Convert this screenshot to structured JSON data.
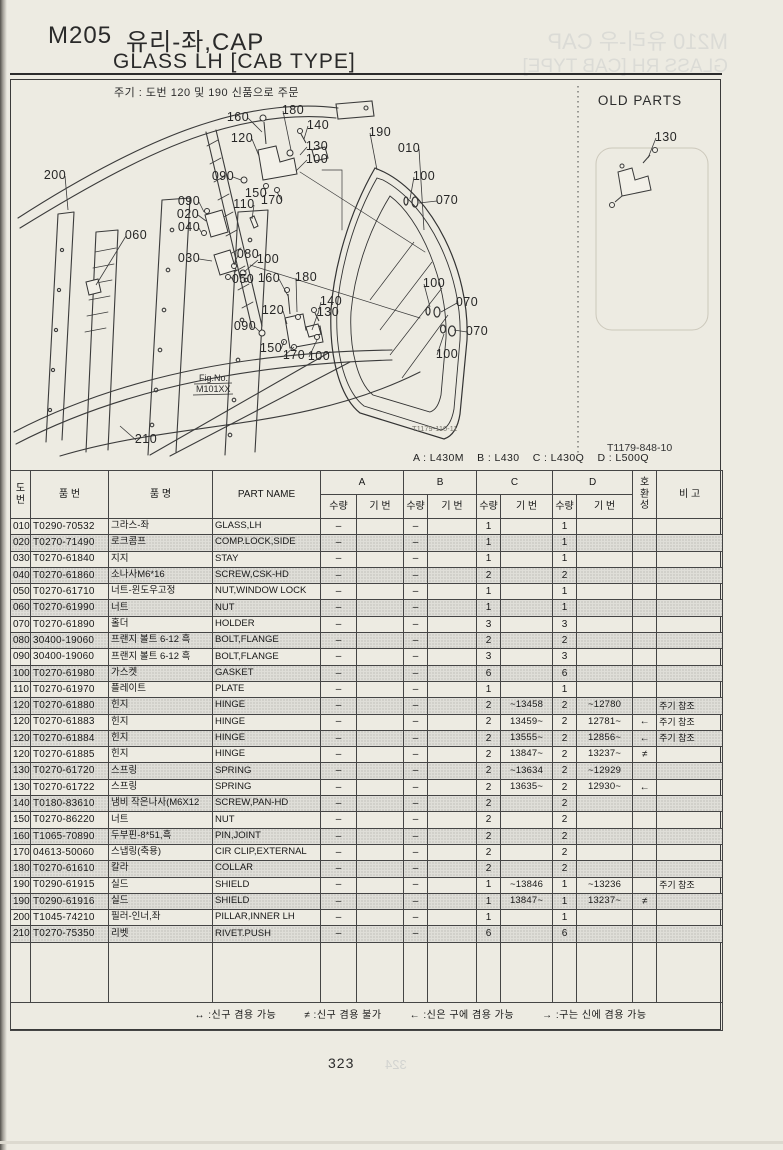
{
  "page": {
    "title_code": "M205",
    "title_kr": "유리-좌,CAP",
    "title_en": "GLASS LH [CAB TYPE]",
    "note": "주기 : 도번 120 및 190 신품으로 주문",
    "page_number": "323"
  },
  "ghost": {
    "line1": "M210 유리-우 CAP",
    "line2": "GLASS RH [CAB TYPE]",
    "next_page": "324"
  },
  "diagram": {
    "old_parts_label": "OLD PARTS",
    "fig_no_label": "Fig.No.",
    "fig_no_value": "M101XX",
    "drawing_code_left": "T1179-110-11",
    "drawing_code_right": "T1179-848-10",
    "callouts": [
      {
        "t": "160",
        "x": 238,
        "y": 121,
        "ex": 262,
        "ey": 132
      },
      {
        "t": "180",
        "x": 293,
        "y": 114,
        "ex": 291,
        "ey": 150
      },
      {
        "t": "140",
        "x": 318,
        "y": 129,
        "ex": 304,
        "ey": 139
      },
      {
        "t": "120",
        "x": 242,
        "y": 142,
        "ex": 259,
        "ey": 156
      },
      {
        "t": "130",
        "x": 317,
        "y": 150,
        "ex": 300,
        "ey": 155
      },
      {
        "t": "100",
        "x": 317,
        "y": 163,
        "ex": 296,
        "ey": 171
      },
      {
        "t": "090",
        "x": 223,
        "y": 180,
        "ex": 241,
        "ey": 180
      },
      {
        "t": "150",
        "x": 256,
        "y": 197,
        "ex": 265,
        "ey": 188
      },
      {
        "t": "170",
        "x": 272,
        "y": 204,
        "ex": 277,
        "ey": 192
      },
      {
        "t": "110",
        "x": 244,
        "y": 208,
        "ex": 252,
        "ey": 219
      },
      {
        "t": "190",
        "x": 380,
        "y": 136,
        "ex": 377,
        "ey": 170
      },
      {
        "t": "010",
        "x": 409,
        "y": 152,
        "ex": 424,
        "ey": 230
      },
      {
        "t": "100",
        "x": 424,
        "y": 180,
        "ex": 410,
        "ey": 199
      },
      {
        "t": "070",
        "x": 447,
        "y": 204,
        "ex": 419,
        "ey": 203
      },
      {
        "t": "090",
        "x": 189,
        "y": 205,
        "ex": 204,
        "ey": 212
      },
      {
        "t": "020",
        "x": 188,
        "y": 218,
        "ex": 206,
        "ey": 221
      },
      {
        "t": "040",
        "x": 189,
        "y": 231,
        "ex": 201,
        "ey": 232
      },
      {
        "t": "030",
        "x": 189,
        "y": 262,
        "ex": 212,
        "ey": 261
      },
      {
        "t": "080",
        "x": 248,
        "y": 258,
        "ex": 234,
        "ey": 265
      },
      {
        "t": "100",
        "x": 268,
        "y": 263,
        "ex": 244,
        "ey": 272
      },
      {
        "t": "050",
        "x": 243,
        "y": 283,
        "ex": 231,
        "ey": 277
      },
      {
        "t": "160",
        "x": 269,
        "y": 282,
        "ex": 288,
        "ey": 296
      },
      {
        "t": "180",
        "x": 306,
        "y": 281,
        "ex": 297,
        "ey": 312
      },
      {
        "t": "140",
        "x": 331,
        "y": 305,
        "ex": 318,
        "ey": 314
      },
      {
        "t": "120",
        "x": 273,
        "y": 314,
        "ex": 287,
        "ey": 324
      },
      {
        "t": "130",
        "x": 328,
        "y": 316,
        "ex": 312,
        "ey": 330
      },
      {
        "t": "090",
        "x": 245,
        "y": 330,
        "ex": 260,
        "ey": 332
      },
      {
        "t": "150",
        "x": 271,
        "y": 352,
        "ex": 284,
        "ey": 341
      },
      {
        "t": "170",
        "x": 294,
        "y": 359,
        "ex": 294,
        "ey": 347
      },
      {
        "t": "100",
        "x": 319,
        "y": 360,
        "ex": 317,
        "ey": 340
      },
      {
        "t": "100",
        "x": 434,
        "y": 287,
        "ex": 430,
        "ey": 307
      },
      {
        "t": "070",
        "x": 467,
        "y": 306,
        "ex": 441,
        "ey": 312
      },
      {
        "t": "070",
        "x": 477,
        "y": 335,
        "ex": 454,
        "ey": 330
      },
      {
        "t": "100",
        "x": 447,
        "y": 358,
        "ex": 444,
        "ey": 334
      },
      {
        "t": "200",
        "x": 55,
        "y": 179,
        "ex": 68,
        "ey": 210
      },
      {
        "t": "060",
        "x": 136,
        "y": 239,
        "ex": 96,
        "ey": 285
      },
      {
        "t": "210",
        "x": 146,
        "y": 443,
        "ex": 120,
        "ey": 426
      },
      {
        "t": "130",
        "x": 666,
        "y": 141,
        "ex": 648,
        "ey": 158
      }
    ]
  },
  "table": {
    "models_line": "A : L430M    B : L430    C : L430Q    D : L500Q",
    "headers": {
      "no_stacked": "도|번",
      "part_no": "품  번",
      "name_kr": "품  명",
      "part_name": "PART NAME",
      "groups": [
        "A",
        "B",
        "C",
        "D"
      ],
      "qty": "수량",
      "serial": "기 번",
      "compat_stacked": "호|환|성",
      "remark": "비  고"
    },
    "rows": [
      {
        "no": "010",
        "pn": "T0290-70532",
        "kr": "그라스-좌",
        "en": "GLASS,LH",
        "aq": "–",
        "as": "",
        "bq": "–",
        "bs": "",
        "cq": "1",
        "cs": "",
        "dq": "1",
        "ds": "",
        "cp": "",
        "rm": "",
        "shaded": false
      },
      {
        "no": "020",
        "pn": "T0270-71490",
        "kr": "로크콤프",
        "en": "COMP.LOCK,SIDE",
        "aq": "–",
        "as": "",
        "bq": "–",
        "bs": "",
        "cq": "1",
        "cs": "",
        "dq": "1",
        "ds": "",
        "cp": "",
        "rm": "",
        "shaded": true
      },
      {
        "no": "030",
        "pn": "T0270-61840",
        "kr": "지지",
        "en": "STAY",
        "aq": "–",
        "as": "",
        "bq": "–",
        "bs": "",
        "cq": "1",
        "cs": "",
        "dq": "1",
        "ds": "",
        "cp": "",
        "rm": "",
        "shaded": false
      },
      {
        "no": "040",
        "pn": "T0270-61860",
        "kr": "소나사M6*16",
        "en": "SCREW,CSK-HD",
        "aq": "–",
        "as": "",
        "bq": "–",
        "bs": "",
        "cq": "2",
        "cs": "",
        "dq": "2",
        "ds": "",
        "cp": "",
        "rm": "",
        "shaded": true
      },
      {
        "no": "050",
        "pn": "T0270-61710",
        "kr": "너트-윈도우고정",
        "en": "NUT,WINDOW LOCK",
        "aq": "–",
        "as": "",
        "bq": "–",
        "bs": "",
        "cq": "1",
        "cs": "",
        "dq": "1",
        "ds": "",
        "cp": "",
        "rm": "",
        "shaded": false
      },
      {
        "no": "060",
        "pn": "T0270-61990",
        "kr": "너트",
        "en": "NUT",
        "aq": "–",
        "as": "",
        "bq": "–",
        "bs": "",
        "cq": "1",
        "cs": "",
        "dq": "1",
        "ds": "",
        "cp": "",
        "rm": "",
        "shaded": true
      },
      {
        "no": "070",
        "pn": "T0270-61890",
        "kr": "홀더",
        "en": "HOLDER",
        "aq": "–",
        "as": "",
        "bq": "–",
        "bs": "",
        "cq": "3",
        "cs": "",
        "dq": "3",
        "ds": "",
        "cp": "",
        "rm": "",
        "shaded": false
      },
      {
        "no": "080",
        "pn": "30400-19060",
        "kr": "프랜지 볼트 6-12 흑",
        "en": "BOLT,FLANGE",
        "aq": "–",
        "as": "",
        "bq": "–",
        "bs": "",
        "cq": "2",
        "cs": "",
        "dq": "2",
        "ds": "",
        "cp": "",
        "rm": "",
        "shaded": true
      },
      {
        "no": "090",
        "pn": "30400-19060",
        "kr": "프랜지 볼트 6-12 흑",
        "en": "BOLT,FLANGE",
        "aq": "–",
        "as": "",
        "bq": "–",
        "bs": "",
        "cq": "3",
        "cs": "",
        "dq": "3",
        "ds": "",
        "cp": "",
        "rm": "",
        "shaded": false
      },
      {
        "no": "100",
        "pn": "T0270-61980",
        "kr": "가스켓",
        "en": "GASKET",
        "aq": "–",
        "as": "",
        "bq": "–",
        "bs": "",
        "cq": "6",
        "cs": "",
        "dq": "6",
        "ds": "",
        "cp": "",
        "rm": "",
        "shaded": true
      },
      {
        "no": "110",
        "pn": "T0270-61970",
        "kr": "플레이트",
        "en": "PLATE",
        "aq": "–",
        "as": "",
        "bq": "–",
        "bs": "",
        "cq": "1",
        "cs": "",
        "dq": "1",
        "ds": "",
        "cp": "",
        "rm": "",
        "shaded": false
      },
      {
        "no": "120",
        "pn": "T0270-61880",
        "kr": "힌지",
        "en": "HINGE",
        "aq": "–",
        "as": "",
        "bq": "–",
        "bs": "",
        "cq": "2",
        "cs": "~13458",
        "dq": "2",
        "ds": "~12780",
        "cp": "",
        "rm": "주기 참조",
        "shaded": true
      },
      {
        "no": "120",
        "pn": "T0270-61883",
        "kr": "힌지",
        "en": "HINGE",
        "aq": "–",
        "as": "",
        "bq": "–",
        "bs": "",
        "cq": "2",
        "cs": "13459~",
        "dq": "2",
        "ds": "12781~",
        "cp": "←",
        "rm": "주기 참조",
        "shaded": false
      },
      {
        "no": "120",
        "pn": "T0270-61884",
        "kr": "힌지",
        "en": "HINGE",
        "aq": "–",
        "as": "",
        "bq": "–",
        "bs": "",
        "cq": "2",
        "cs": "13555~",
        "dq": "2",
        "ds": "12856~",
        "cp": "←",
        "rm": "주기 참조",
        "shaded": true
      },
      {
        "no": "120",
        "pn": "T0270-61885",
        "kr": "힌지",
        "en": "HINGE",
        "aq": "–",
        "as": "",
        "bq": "–",
        "bs": "",
        "cq": "2",
        "cs": "13847~",
        "dq": "2",
        "ds": "13237~",
        "cp": "≠",
        "rm": "",
        "shaded": false
      },
      {
        "no": "130",
        "pn": "T0270-61720",
        "kr": "스프링",
        "en": "SPRING",
        "aq": "–",
        "as": "",
        "bq": "–",
        "bs": "",
        "cq": "2",
        "cs": "~13634",
        "dq": "2",
        "ds": "~12929",
        "cp": "",
        "rm": "",
        "shaded": true
      },
      {
        "no": "130",
        "pn": "T0270-61722",
        "kr": "스프링",
        "en": "SPRING",
        "aq": "–",
        "as": "",
        "bq": "–",
        "bs": "",
        "cq": "2",
        "cs": "13635~",
        "dq": "2",
        "ds": "12930~",
        "cp": "←",
        "rm": "",
        "shaded": false
      },
      {
        "no": "140",
        "pn": "T0180-83610",
        "kr": "냄비 작은나사(M6X12",
        "en": "SCREW,PAN-HD",
        "aq": "–",
        "as": "",
        "bq": "–",
        "bs": "",
        "cq": "2",
        "cs": "",
        "dq": "2",
        "ds": "",
        "cp": "",
        "rm": "",
        "shaded": true
      },
      {
        "no": "150",
        "pn": "T0270-86220",
        "kr": "너트",
        "en": "NUT",
        "aq": "–",
        "as": "",
        "bq": "–",
        "bs": "",
        "cq": "2",
        "cs": "",
        "dq": "2",
        "ds": "",
        "cp": "",
        "rm": "",
        "shaded": false
      },
      {
        "no": "160",
        "pn": "T1065-70890",
        "kr": "두부핀-8*51,흑",
        "en": "PIN,JOINT",
        "aq": "–",
        "as": "",
        "bq": "–",
        "bs": "",
        "cq": "2",
        "cs": "",
        "dq": "2",
        "ds": "",
        "cp": "",
        "rm": "",
        "shaded": true
      },
      {
        "no": "170",
        "pn": "04613-50060",
        "kr": "스냅링(축용)",
        "en": "CIR CLIP,EXTERNAL",
        "aq": "–",
        "as": "",
        "bq": "–",
        "bs": "",
        "cq": "2",
        "cs": "",
        "dq": "2",
        "ds": "",
        "cp": "",
        "rm": "",
        "shaded": false
      },
      {
        "no": "180",
        "pn": "T0270-61610",
        "kr": "칼라",
        "en": "COLLAR",
        "aq": "–",
        "as": "",
        "bq": "–",
        "bs": "",
        "cq": "2",
        "cs": "",
        "dq": "2",
        "ds": "",
        "cp": "",
        "rm": "",
        "shaded": true
      },
      {
        "no": "190",
        "pn": "T0290-61915",
        "kr": "실드",
        "en": "SHIELD",
        "aq": "–",
        "as": "",
        "bq": "–",
        "bs": "",
        "cq": "1",
        "cs": "~13846",
        "dq": "1",
        "ds": "~13236",
        "cp": "",
        "rm": "주기 참조",
        "shaded": false
      },
      {
        "no": "190",
        "pn": "T0290-61916",
        "kr": "실드",
        "en": "SHIELD",
        "aq": "–",
        "as": "",
        "bq": "–",
        "bs": "",
        "cq": "1",
        "cs": "13847~",
        "dq": "1",
        "ds": "13237~",
        "cp": "≠",
        "rm": "",
        "shaded": true
      },
      {
        "no": "200",
        "pn": "T1045-74210",
        "kr": "필러-인너,좌",
        "en": "PILLAR,INNER LH",
        "aq": "–",
        "as": "",
        "bq": "–",
        "bs": "",
        "cq": "1",
        "cs": "",
        "dq": "1",
        "ds": "",
        "cp": "",
        "rm": "",
        "shaded": false
      },
      {
        "no": "210",
        "pn": "T0270-75350",
        "kr": "리벳",
        "en": "RIVET.PUSH",
        "aq": "–",
        "as": "",
        "bq": "–",
        "bs": "",
        "cq": "6",
        "cs": "",
        "dq": "6",
        "ds": "",
        "cp": "",
        "rm": "",
        "shaded": true
      }
    ]
  },
  "legend": {
    "items": [
      "↔ :신구 겸용 가능",
      "≠ :신구 겸용 불가",
      "← :신은 구에 겸용 가능",
      "→ :구는 신에 겸용 가능"
    ]
  }
}
